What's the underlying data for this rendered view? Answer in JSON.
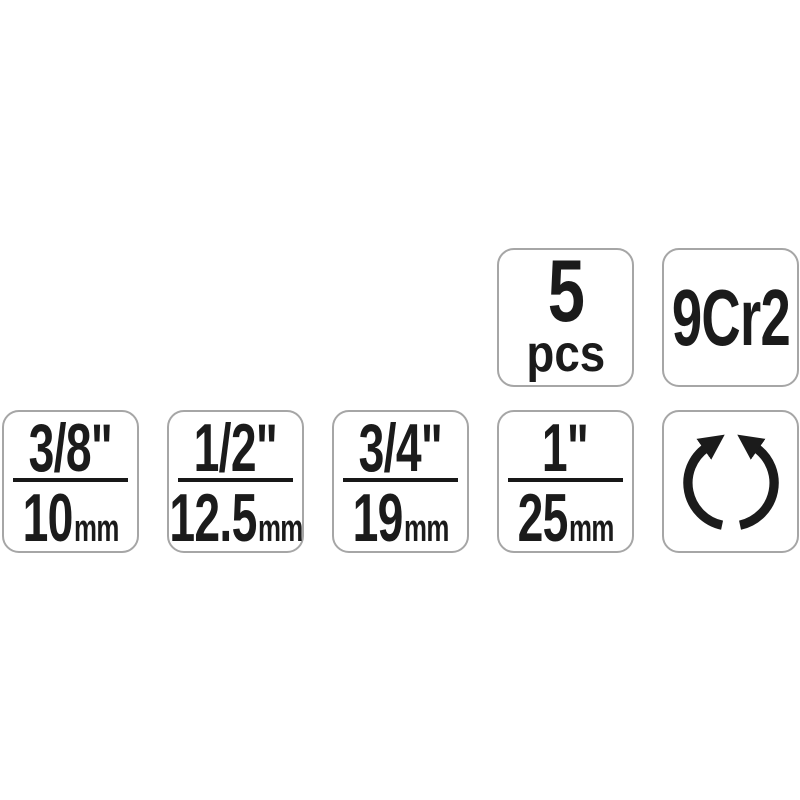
{
  "page": {
    "background_color": "#ffffff",
    "description": "product specification badge strip"
  },
  "colors": {
    "badge_background": "#ffffff",
    "badge_border": "#a6a6a6",
    "text": "#1b1b1b"
  },
  "pieces_badge": {
    "count": "5",
    "unit": "pcs"
  },
  "material_badge": {
    "grade": "9Cr2"
  },
  "size_badges": [
    {
      "inch": "3/8\"",
      "mm_value": "10",
      "mm_unit": "mm"
    },
    {
      "inch": "1/2\"",
      "mm_value": "12.5",
      "mm_unit": "mm"
    },
    {
      "inch": "3/4\"",
      "mm_value": "19",
      "mm_unit": "mm"
    },
    {
      "inch": "1\"",
      "mm_value": "25",
      "mm_unit": "mm"
    }
  ],
  "rotation_badge": {
    "icon": "rotate-both-directions-icon"
  }
}
